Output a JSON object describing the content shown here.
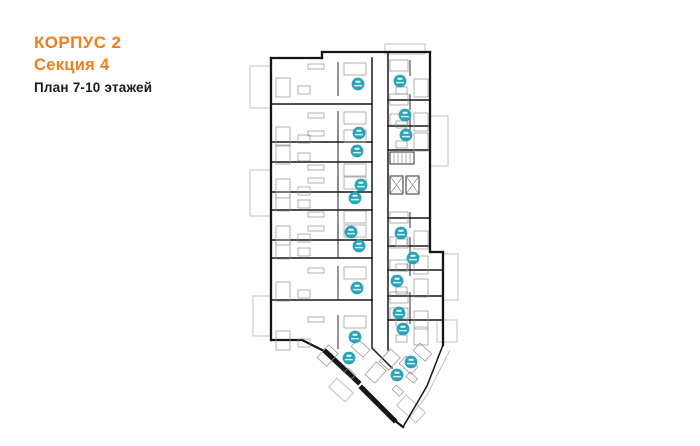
{
  "header": {
    "building": "КОРПУС 2",
    "section": "Секция 4",
    "floors_label": "План 7-10 этажей"
  },
  "colors": {
    "accent": "#EF7F1B",
    "heading_text": "#1A1A1A",
    "marker": "#27A4B8",
    "wall": "#161616",
    "partition": "#8F8F8F",
    "balcony": "#C5C5C5"
  },
  "plan": {
    "marker_count": 20,
    "markers": [
      {
        "col": "L",
        "x": 358,
        "y": 84
      },
      {
        "col": "R",
        "x": 400,
        "y": 81
      },
      {
        "col": "R",
        "x": 405,
        "y": 115
      },
      {
        "col": "L",
        "x": 359,
        "y": 133
      },
      {
        "col": "R",
        "x": 406,
        "y": 135
      },
      {
        "col": "L",
        "x": 357,
        "y": 151
      },
      {
        "col": "L",
        "x": 361,
        "y": 185
      },
      {
        "col": "L",
        "x": 355,
        "y": 198
      },
      {
        "col": "L",
        "x": 351,
        "y": 232
      },
      {
        "col": "R",
        "x": 401,
        "y": 233
      },
      {
        "col": "L",
        "x": 359,
        "y": 246
      },
      {
        "col": "R",
        "x": 413,
        "y": 258
      },
      {
        "col": "R",
        "x": 397,
        "y": 281
      },
      {
        "col": "L",
        "x": 357,
        "y": 288
      },
      {
        "col": "R",
        "x": 399,
        "y": 313
      },
      {
        "col": "R",
        "x": 403,
        "y": 329
      },
      {
        "col": "L",
        "x": 355,
        "y": 337
      },
      {
        "col": "W",
        "x": 349,
        "y": 358
      },
      {
        "col": "W",
        "x": 411,
        "y": 362
      },
      {
        "col": "W",
        "x": 397,
        "y": 375
      }
    ]
  }
}
